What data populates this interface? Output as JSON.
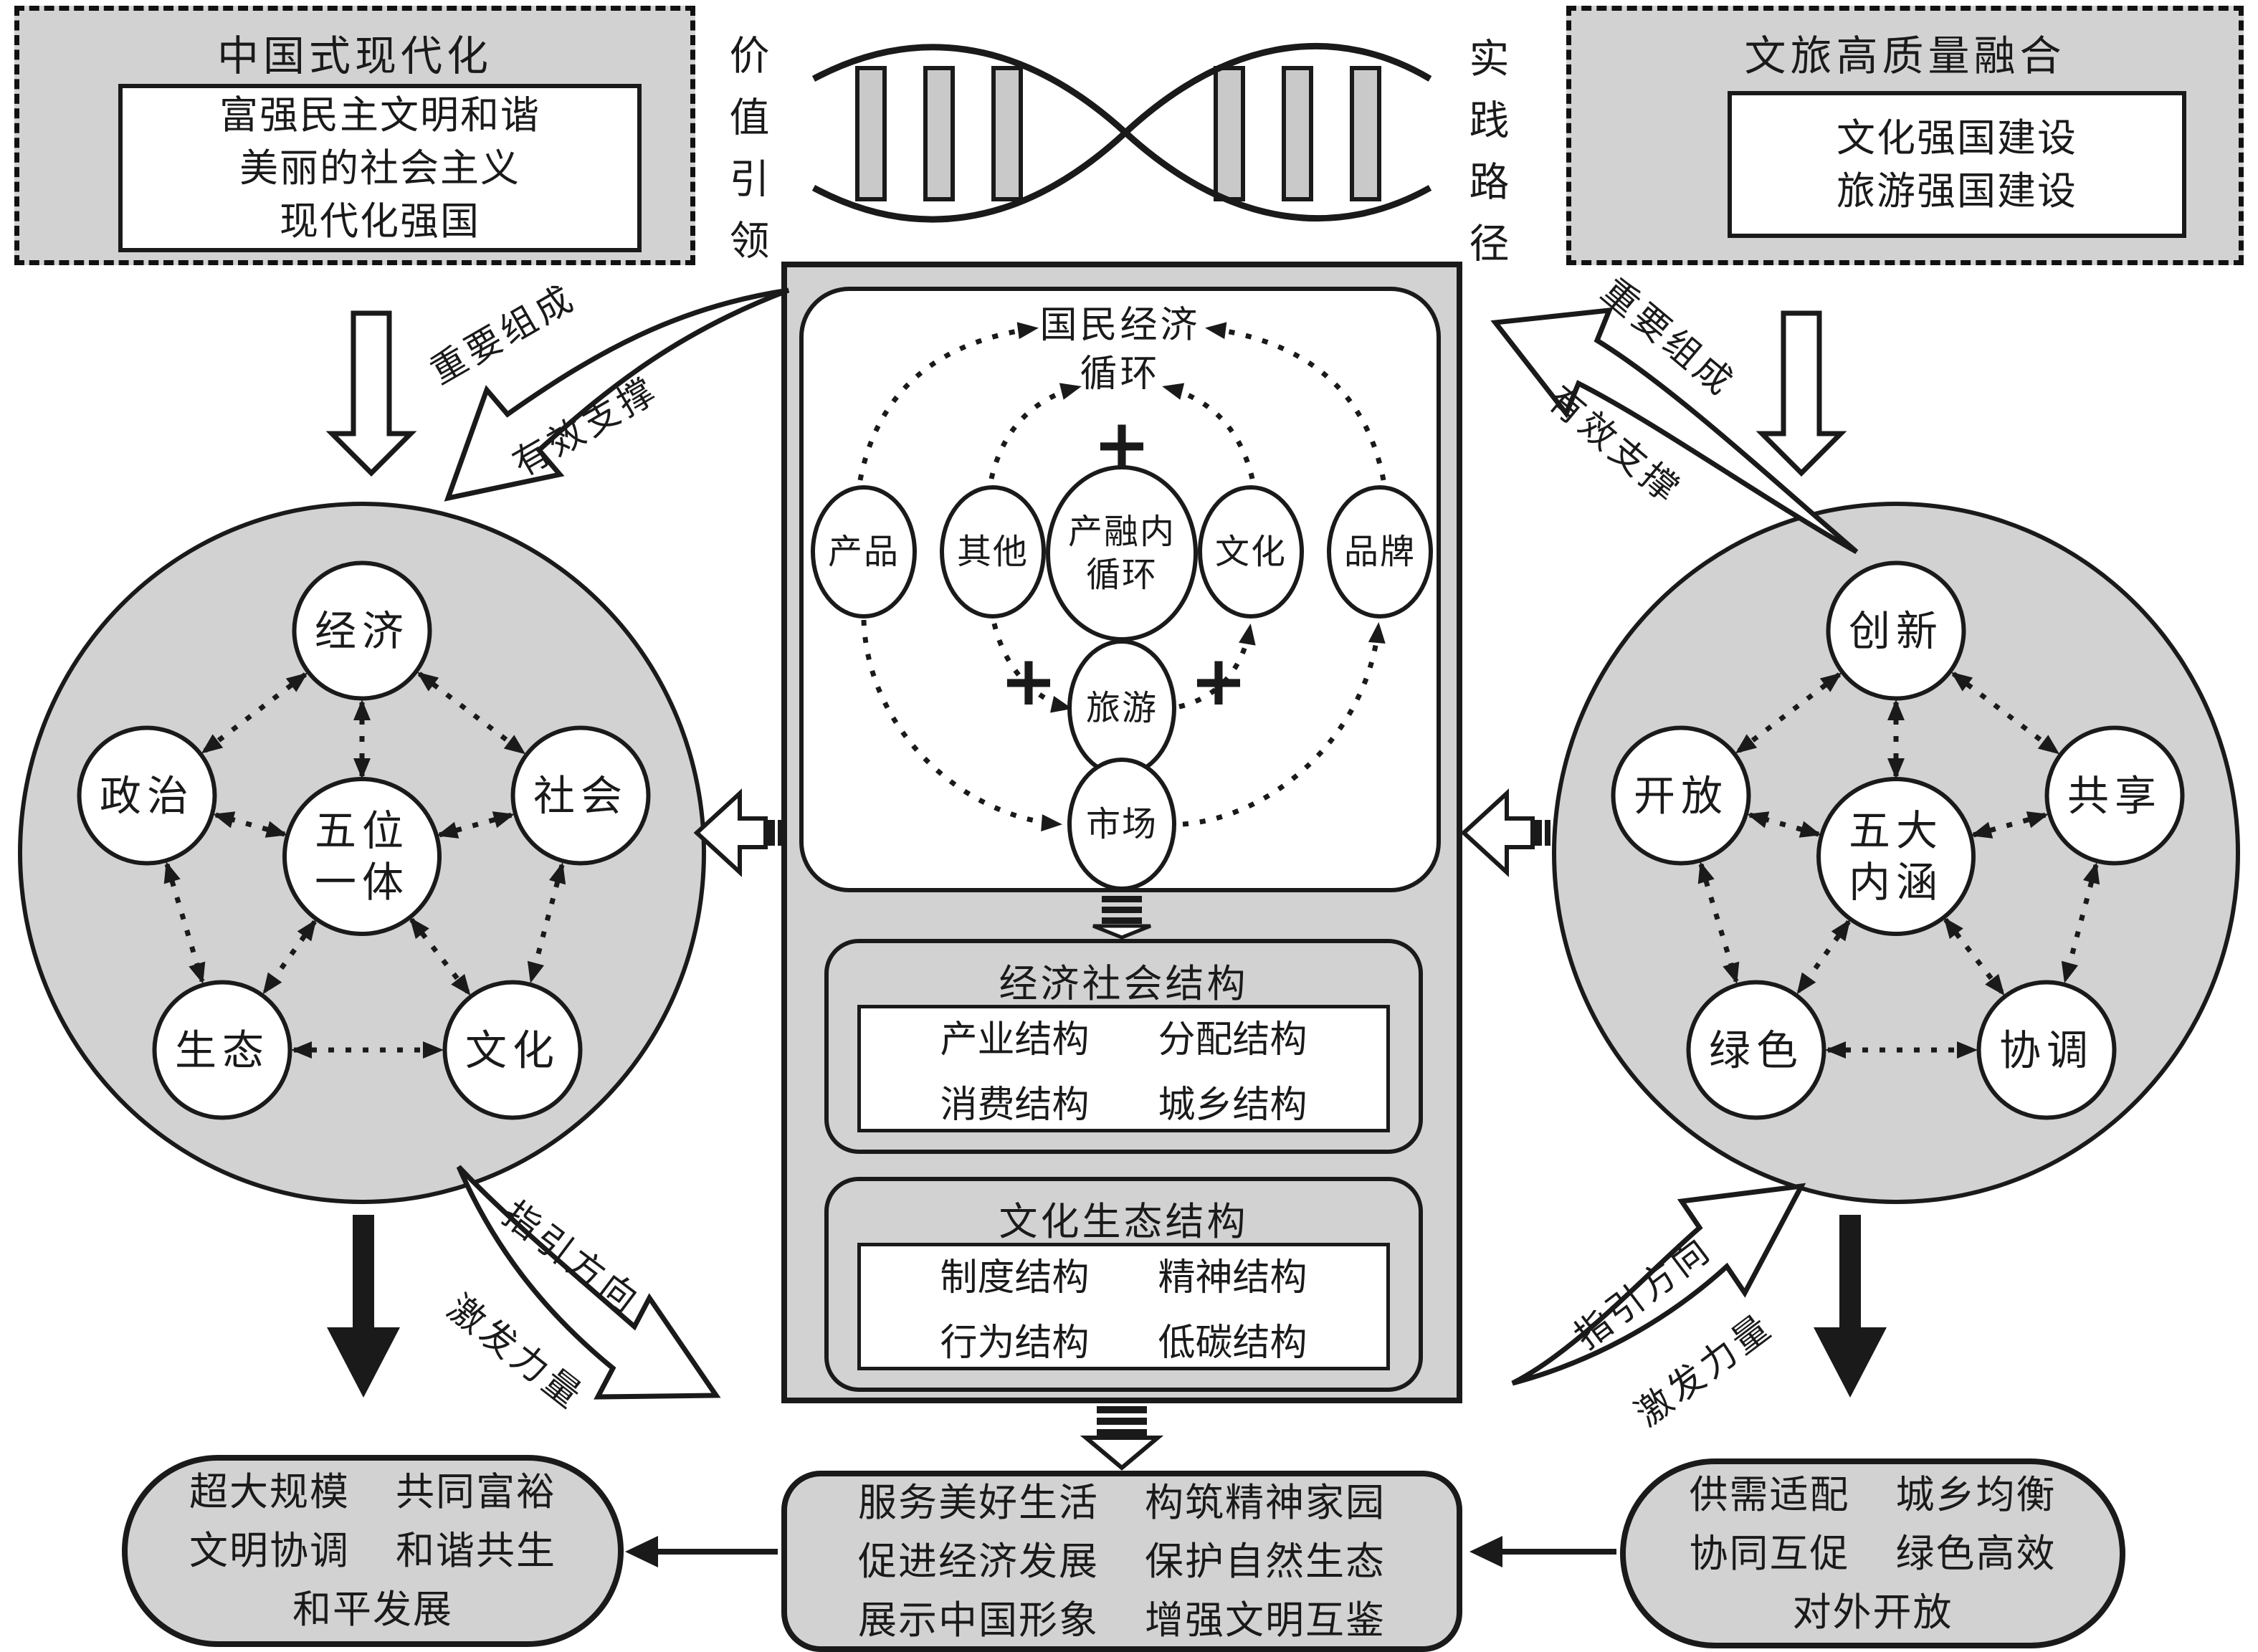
{
  "colors": {
    "gray_fill": "#d2d2d2",
    "dna_bar_fill": "#c9c9c9",
    "line": "#1a1a1a",
    "white": "#ffffff"
  },
  "top_left_box": {
    "title": "中国式现代化",
    "lines": [
      "富强民主文明和谐",
      "美丽的社会主义",
      "现代化强国"
    ]
  },
  "top_right_box": {
    "title": "文旅高质量融合",
    "lines": [
      "文化强国建设",
      "旅游强国建设"
    ]
  },
  "dna": {
    "left_label": "价值引领",
    "right_label": "实践路径"
  },
  "left_circle": {
    "center_lines": [
      "五位",
      "一体"
    ],
    "nodes": [
      "经济",
      "政治",
      "社会",
      "生态",
      "文化"
    ]
  },
  "right_circle": {
    "center_lines": [
      "五大",
      "内涵"
    ],
    "nodes": [
      "创新",
      "开放",
      "共享",
      "绿色",
      "协调"
    ]
  },
  "central": {
    "cycle": {
      "title_lines": [
        "国民经济",
        "循环"
      ],
      "core_lines": [
        "产融内",
        "循环"
      ],
      "nodes": [
        "产品",
        "其他",
        "文化",
        "品牌",
        "旅游",
        "市场"
      ],
      "plus": "+"
    },
    "economic_structure": {
      "title": "经济社会结构",
      "items": [
        "产业结构",
        "分配结构",
        "消费结构",
        "城乡结构"
      ]
    },
    "cultural_structure": {
      "title": "文化生态结构",
      "items": [
        "制度结构",
        "精神结构",
        "行为结构",
        "低碳结构"
      ]
    }
  },
  "curved_labels": {
    "top_left": {
      "upper": "重要组成",
      "lower": "有效支撑"
    },
    "top_right": {
      "upper": "重要组成",
      "lower": "有效支撑"
    },
    "bottom_left": {
      "upper": "指引方向",
      "lower": "激发力量"
    },
    "bottom_right": {
      "upper": "指引方向",
      "lower": "激发力量"
    }
  },
  "bottom_left_box": {
    "rows": [
      [
        "超大规模",
        "共同富裕"
      ],
      [
        "文明协调",
        "和谐共生"
      ],
      [
        "和平发展"
      ]
    ]
  },
  "bottom_center_box": {
    "rows": [
      [
        "服务美好生活",
        "构筑精神家园"
      ],
      [
        "促进经济发展",
        "保护自然生态"
      ],
      [
        "展示中国形象",
        "增强文明互鉴"
      ]
    ]
  },
  "bottom_right_box": {
    "rows": [
      [
        "供需适配",
        "城乡均衡"
      ],
      [
        "协同互促",
        "绿色高效"
      ],
      [
        "对外开放"
      ]
    ]
  }
}
